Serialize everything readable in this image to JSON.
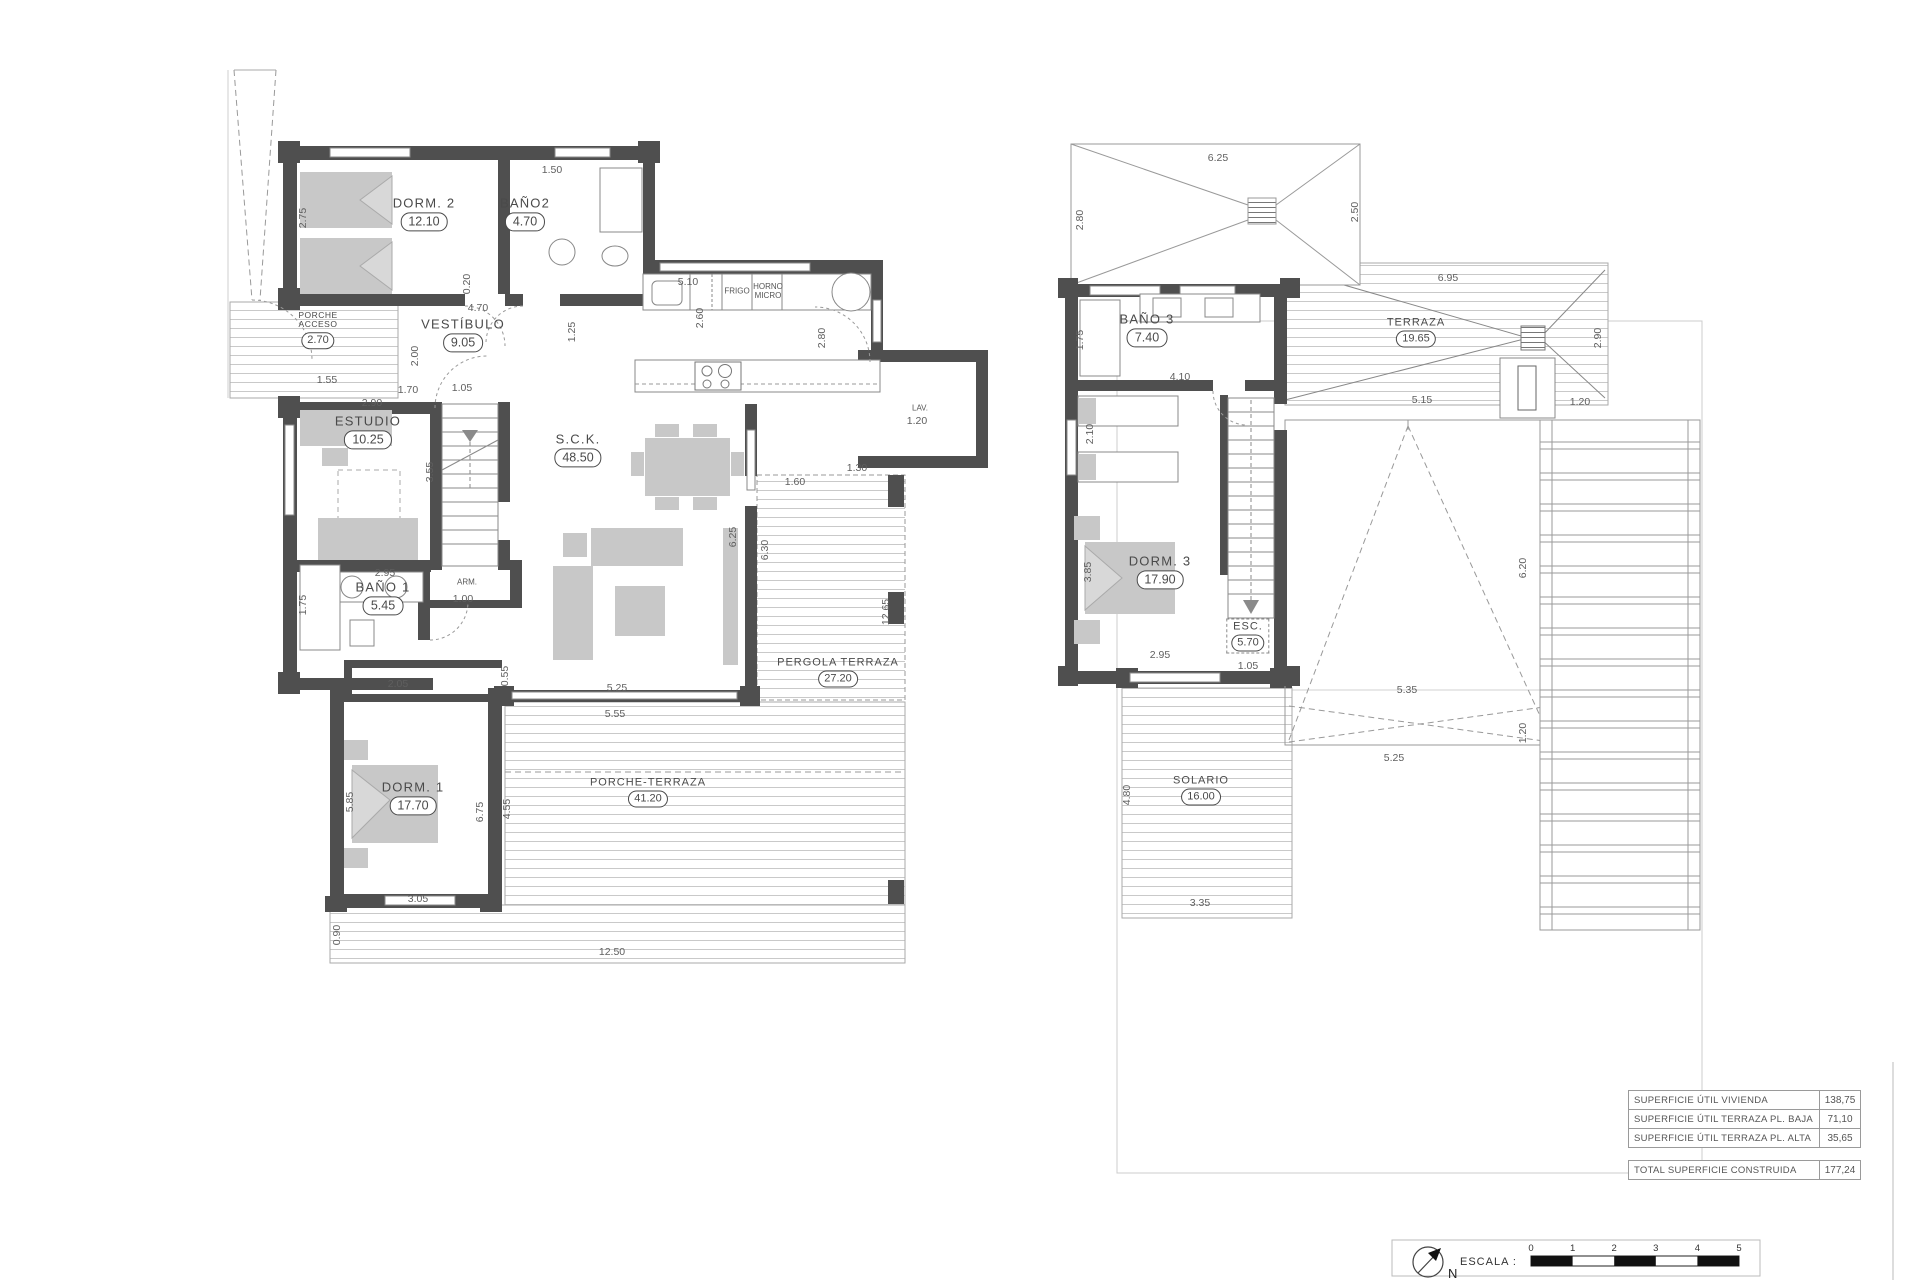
{
  "sheet": {
    "north_label": "N",
    "scale_label": "ESCALA :",
    "scale_ticks": [
      "0",
      "1",
      "2",
      "3",
      "4",
      "5"
    ]
  },
  "summary_table": {
    "rows": [
      {
        "label": "SUPERFICIE ÚTIL VIVIENDA",
        "value": "138,75"
      },
      {
        "label": "SUPERFICIE ÚTIL TERRAZA PL. BAJA",
        "value": "71,10"
      },
      {
        "label": "SUPERFICIE ÚTIL TERRAZA PL. ALTA",
        "value": "35,65"
      }
    ],
    "total": {
      "label": "TOTAL SUPERFICIE CONSTRUIDA",
      "value": "177,24"
    }
  },
  "floors": [
    {
      "name": "planta-baja",
      "rooms": [
        {
          "label": "DORM. 2",
          "area": "12.10",
          "x": 424,
          "y": 214
        },
        {
          "label": "BAÑO2",
          "area": "4.70",
          "x": 525,
          "y": 214
        },
        {
          "label": "PORCHE\nACCESO",
          "area": "2.70",
          "x": 318,
          "y": 330,
          "cls": "tiny"
        },
        {
          "label": "VESTÍBULO",
          "area": "9.05",
          "x": 463,
          "y": 335
        },
        {
          "label": "ESTUDIO",
          "area": "10.25",
          "x": 368,
          "y": 432
        },
        {
          "label": "BAÑO 1",
          "area": "5.45",
          "x": 383,
          "y": 598
        },
        {
          "label": "S.C.K.",
          "area": "48.50",
          "x": 578,
          "y": 450
        },
        {
          "label": "DORM. 1",
          "area": "17.70",
          "x": 413,
          "y": 798
        },
        {
          "label": "PERGOLA TERRAZA",
          "area": "27.20",
          "x": 838,
          "y": 672,
          "cls": "small"
        },
        {
          "label": "PORCHE-TERRAZA",
          "area": "41.20",
          "x": 648,
          "y": 792,
          "cls": "small"
        }
      ],
      "annotations": [
        {
          "text": "FRIGO",
          "x": 737,
          "y": 291
        },
        {
          "text": "HORNO\nMICRO",
          "x": 768,
          "y": 291
        },
        {
          "text": "LAV.",
          "x": 920,
          "y": 408
        },
        {
          "text": "ARM.",
          "x": 467,
          "y": 582
        }
      ],
      "dims": [
        {
          "t": "2.75",
          "x": 303,
          "y": 218,
          "r": 1
        },
        {
          "t": "1.50",
          "x": 552,
          "y": 170
        },
        {
          "t": "0.20",
          "x": 467,
          "y": 284,
          "r": 1
        },
        {
          "t": "4.70",
          "x": 478,
          "y": 308
        },
        {
          "t": "5.10",
          "x": 688,
          "y": 282
        },
        {
          "t": "2.60",
          "x": 700,
          "y": 318,
          "r": 1
        },
        {
          "t": "1.25",
          "x": 572,
          "y": 332,
          "r": 1
        },
        {
          "t": "2.90",
          "x": 372,
          "y": 403
        },
        {
          "t": "2.00",
          "x": 415,
          "y": 356,
          "r": 1
        },
        {
          "t": "1.70",
          "x": 408,
          "y": 390
        },
        {
          "t": "1.55",
          "x": 327,
          "y": 380
        },
        {
          "t": "1.05",
          "x": 462,
          "y": 388
        },
        {
          "t": "3.55",
          "x": 430,
          "y": 472,
          "r": 1
        },
        {
          "t": "2.95",
          "x": 385,
          "y": 573
        },
        {
          "t": "1.75",
          "x": 303,
          "y": 605,
          "r": 1
        },
        {
          "t": "1.00",
          "x": 463,
          "y": 599
        },
        {
          "t": "2.05",
          "x": 398,
          "y": 684
        },
        {
          "t": "0.55",
          "x": 505,
          "y": 676,
          "r": 1
        },
        {
          "t": "5.25",
          "x": 617,
          "y": 688
        },
        {
          "t": "5.55",
          "x": 615,
          "y": 714
        },
        {
          "t": "6.25",
          "x": 733,
          "y": 537,
          "r": 1
        },
        {
          "t": "6.30",
          "x": 765,
          "y": 550,
          "r": 1
        },
        {
          "t": "12.65",
          "x": 886,
          "y": 612,
          "r": 1
        },
        {
          "t": "2.80",
          "x": 822,
          "y": 338,
          "r": 1
        },
        {
          "t": "1.30",
          "x": 857,
          "y": 468
        },
        {
          "t": "1.60",
          "x": 795,
          "y": 482
        },
        {
          "t": "1.20",
          "x": 917,
          "y": 421
        },
        {
          "t": "5.85",
          "x": 350,
          "y": 802,
          "r": 1
        },
        {
          "t": "6.75",
          "x": 480,
          "y": 812,
          "r": 1
        },
        {
          "t": "4.55",
          "x": 507,
          "y": 809,
          "r": 1
        },
        {
          "t": "3.05",
          "x": 418,
          "y": 899
        },
        {
          "t": "0.90",
          "x": 337,
          "y": 935,
          "r": 1
        },
        {
          "t": "12.50",
          "x": 612,
          "y": 952
        }
      ]
    },
    {
      "name": "planta-alta",
      "rooms": [
        {
          "label": "BAÑO 3",
          "area": "7.40",
          "x": 1147,
          "y": 330
        },
        {
          "label": "TERRAZA",
          "area": "19.65",
          "x": 1416,
          "y": 332,
          "cls": "small"
        },
        {
          "label": "DORM. 3",
          "area": "17.90",
          "x": 1160,
          "y": 572
        },
        {
          "label": "ESC.",
          "area": "5.70",
          "x": 1248,
          "y": 636,
          "cls": "small dashedbox"
        },
        {
          "label": "SOLARIO",
          "area": "16.00",
          "x": 1201,
          "y": 790,
          "cls": "small"
        }
      ],
      "annotations": [],
      "dims": [
        {
          "t": "6.25",
          "x": 1218,
          "y": 158
        },
        {
          "t": "2.80",
          "x": 1080,
          "y": 220,
          "r": 1
        },
        {
          "t": "2.50",
          "x": 1355,
          "y": 212,
          "r": 1
        },
        {
          "t": "6.95",
          "x": 1448,
          "y": 278
        },
        {
          "t": "2.90",
          "x": 1598,
          "y": 338,
          "r": 1
        },
        {
          "t": "5.15",
          "x": 1422,
          "y": 400
        },
        {
          "t": "1.20",
          "x": 1580,
          "y": 402
        },
        {
          "t": "1.75",
          "x": 1080,
          "y": 340,
          "r": 1
        },
        {
          "t": "4.10",
          "x": 1180,
          "y": 377
        },
        {
          "t": "2.10",
          "x": 1090,
          "y": 434,
          "r": 1
        },
        {
          "t": "3.85",
          "x": 1088,
          "y": 572,
          "r": 1
        },
        {
          "t": "2.95",
          "x": 1160,
          "y": 655
        },
        {
          "t": "1.05",
          "x": 1248,
          "y": 666
        },
        {
          "t": "5.35",
          "x": 1407,
          "y": 690
        },
        {
          "t": "5.25",
          "x": 1394,
          "y": 758
        },
        {
          "t": "1.20",
          "x": 1523,
          "y": 733,
          "r": 1
        },
        {
          "t": "6.20",
          "x": 1523,
          "y": 568,
          "r": 1
        },
        {
          "t": "4.80",
          "x": 1127,
          "y": 795,
          "r": 1
        },
        {
          "t": "3.35",
          "x": 1200,
          "y": 903
        }
      ]
    }
  ]
}
